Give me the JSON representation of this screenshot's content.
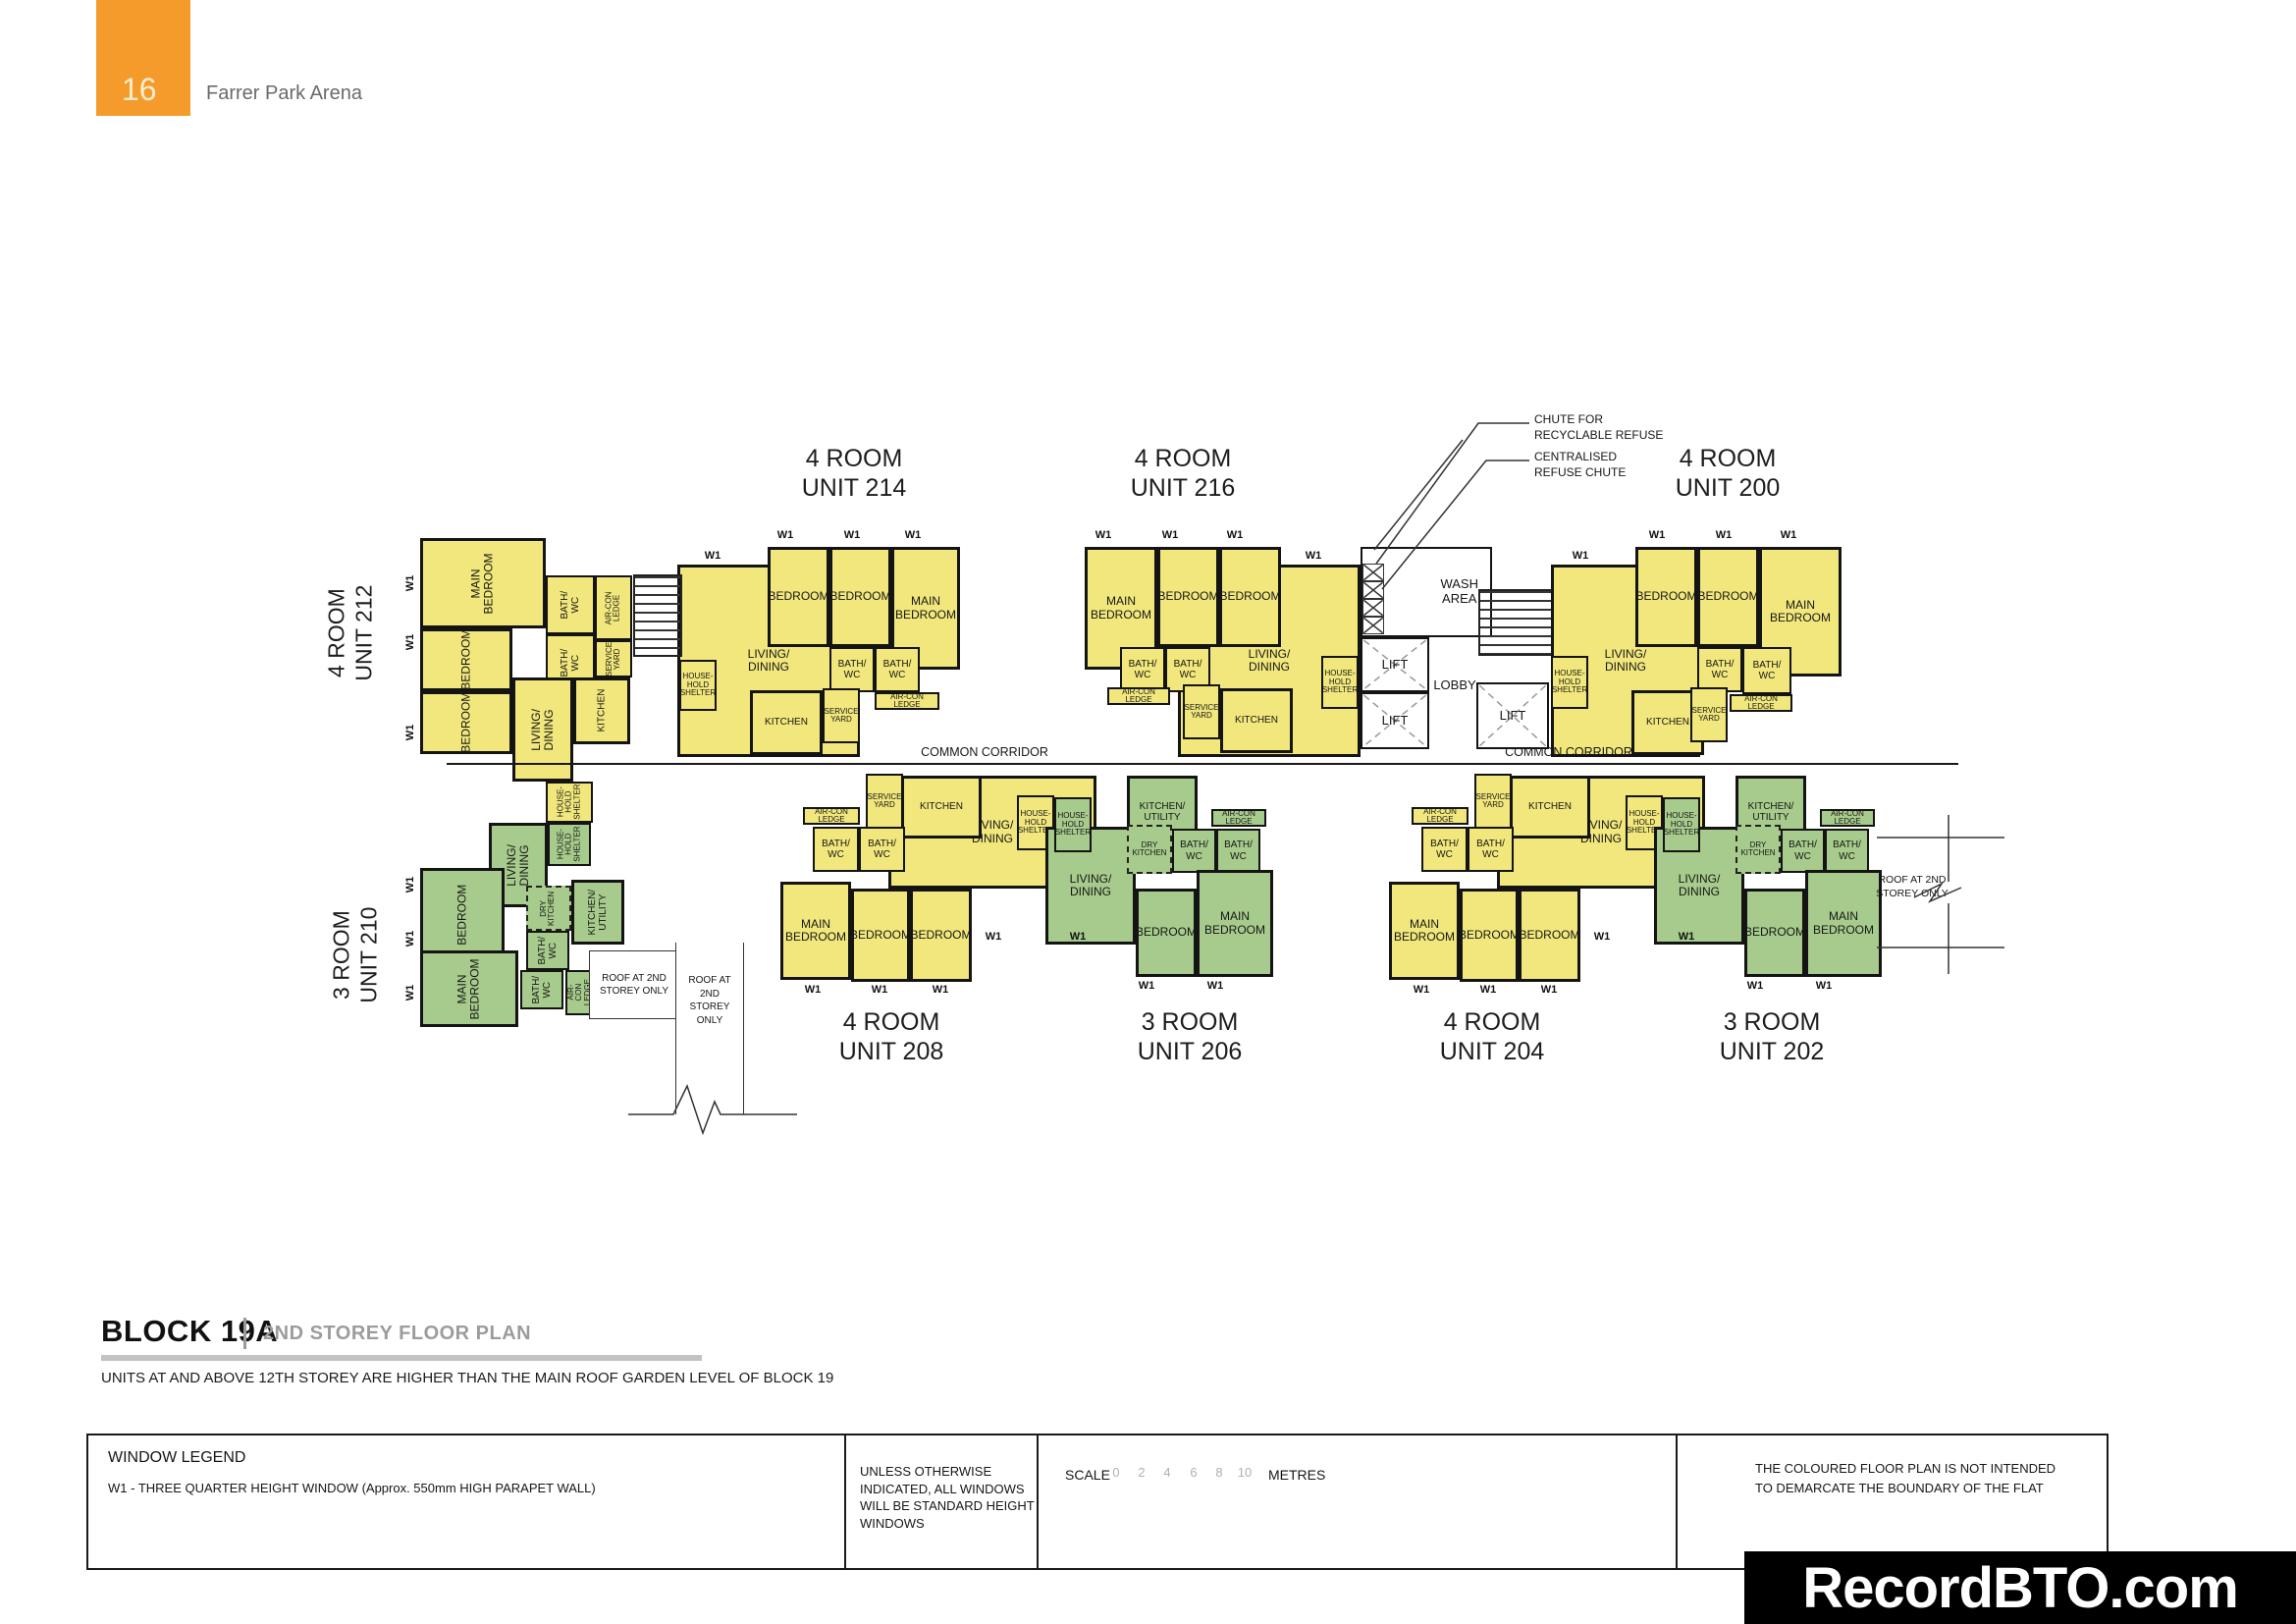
{
  "page": {
    "number": "16",
    "project": "Farrer Park Arena"
  },
  "colors": {
    "four_room_fill": "#F1E77C",
    "three_room_fill": "#A7CB8C",
    "accent_orange": "#F59B2C",
    "wall": "#141414"
  },
  "annotations": {
    "chute_recyclable": "CHUTE FOR\nRECYCLABLE REFUSE",
    "chute_centralised": "CENTRALISED\nREFUSE CHUTE",
    "wash_area": "WASH\nAREA",
    "lift": "LIFT",
    "lobby": "LOBBY",
    "common_corridor": "COMMON CORRIDOR",
    "roof_2line": "ROOF AT 2ND\nSTOREY ONLY",
    "roof_4line": "ROOF AT\n2ND\nSTOREY\nONLY",
    "w1": "W1"
  },
  "rooms": {
    "main_bedroom": "MAIN\nBEDROOM",
    "bedroom": "BEDROOM",
    "living_dining": "LIVING/\nDINING",
    "kitchen": "KITCHEN",
    "kitchen_utility": "KITCHEN/\nUTILITY",
    "dry_kitchen": "DRY\nKITCHEN",
    "bath_wc": "BATH/\nWC",
    "service_yard": "SERVICE\nYARD",
    "household_shelter": "HOUSE-\nHOLD\nSHELTER",
    "aircon_ledge": "AIR-CON\nLEDGE"
  },
  "units": {
    "u212": {
      "type": "4 ROOM",
      "unit": "UNIT 212",
      "color": "#F1E77C"
    },
    "u214": {
      "type": "4 ROOM",
      "unit": "UNIT 214",
      "color": "#F1E77C"
    },
    "u216": {
      "type": "4 ROOM",
      "unit": "UNIT 216",
      "color": "#F1E77C"
    },
    "u200": {
      "type": "4 ROOM",
      "unit": "UNIT 200",
      "color": "#F1E77C"
    },
    "u210": {
      "type": "3 ROOM",
      "unit": "UNIT 210",
      "color": "#A7CB8C"
    },
    "u208": {
      "type": "4 ROOM",
      "unit": "UNIT 208",
      "color": "#F1E77C"
    },
    "u206": {
      "type": "3 ROOM",
      "unit": "UNIT 206",
      "color": "#A7CB8C"
    },
    "u204": {
      "type": "4 ROOM",
      "unit": "UNIT 204",
      "color": "#F1E77C"
    },
    "u202": {
      "type": "3 ROOM",
      "unit": "UNIT 202",
      "color": "#A7CB8C"
    }
  },
  "title_block": {
    "block": "BLOCK 19A",
    "subtitle": "2ND STOREY FLOOR PLAN",
    "note": "UNITS AT AND ABOVE 12TH STOREY ARE HIGHER THAN THE MAIN ROOF GARDEN LEVEL OF BLOCK 19"
  },
  "legend": {
    "window_legend_title": "WINDOW LEGEND",
    "window_legend_item": "W1 - THREE QUARTER HEIGHT WINDOW (Approx. 550mm HIGH PARAPET WALL)",
    "windows_note": "UNLESS OTHERWISE INDICATED, ALL WINDOWS WILL BE STANDARD HEIGHT WINDOWS",
    "scale_label": "SCALE",
    "scale_ticks": [
      "0",
      "2",
      "4",
      "6",
      "8",
      "10"
    ],
    "scale_unit": "METRES",
    "boundary_note": "THE COLOURED FLOOR PLAN IS NOT INTENDED\nTO DEMARCATE THE BOUNDARY OF THE FLAT"
  },
  "watermark": "RecordBTO.com"
}
